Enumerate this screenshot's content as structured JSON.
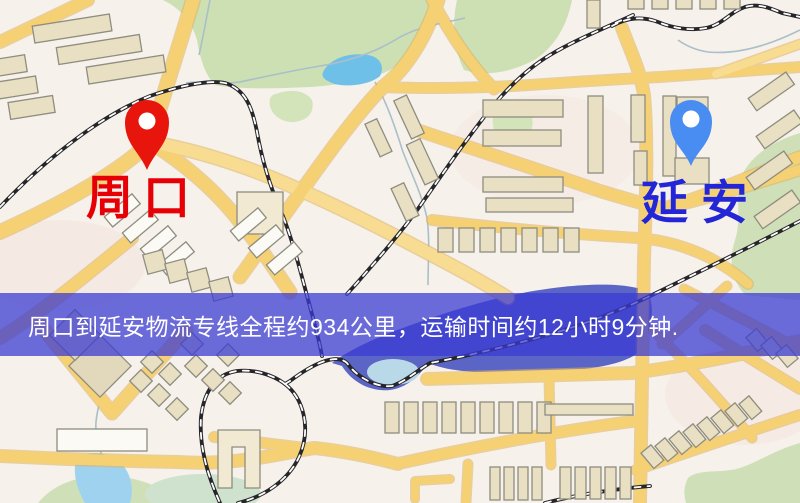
{
  "banner": {
    "text": "周口到延安物流专线全程约934公里，运输时间约12小时9分钟.",
    "background_color": "#3a3ad2",
    "text_color": "#ffffff"
  },
  "map": {
    "labels": {
      "origin": {
        "text": "周口",
        "color": "#e60005"
      },
      "destination": {
        "text": "延安",
        "color": "#2326d6"
      }
    },
    "markers": {
      "origin": {
        "icon": "map-pin",
        "color": "#e8150d"
      },
      "destination": {
        "icon": "map-pin",
        "color": "#4a8df2"
      }
    },
    "route": {
      "distance_km": 934,
      "duration": "12小时9分钟"
    },
    "palette": {
      "base": "#f6f1ea",
      "road": "#f5d174",
      "road_casing": "#e0b25c",
      "building": "#e9dfc2",
      "building_outline": "#8e8d80",
      "park": "#cde0b4",
      "river": "#5a65c6",
      "pond": "#6fc0e8",
      "lake": "#9fd2ee",
      "railway": "#26262a"
    }
  }
}
